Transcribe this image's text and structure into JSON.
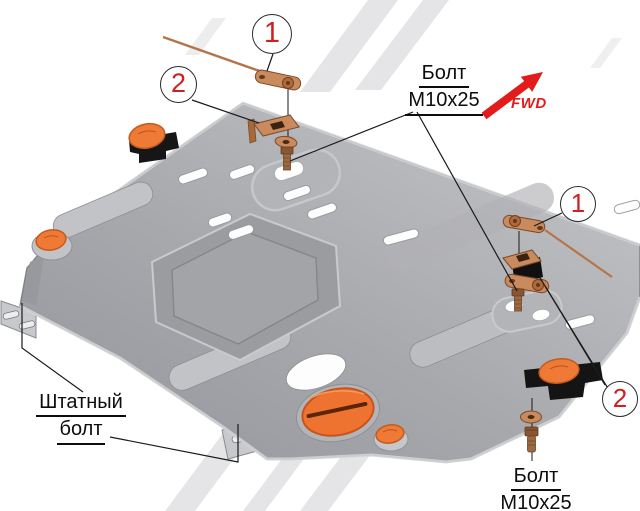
{
  "diagram": {
    "kind": "exploded installation diagram",
    "subject": "engine skid plate with mounting hardware"
  },
  "labels": {
    "bolt_top": {
      "line1": "Болт",
      "line2": "М10х25"
    },
    "bolt_bottom": {
      "line1": "Болт",
      "line2": "М10х25"
    },
    "stock_bolt": {
      "line1": "Штатный",
      "line2": "болт"
    },
    "fwd": "FWD"
  },
  "callouts": [
    {
      "number": "1",
      "position": "top"
    },
    {
      "number": "2",
      "position": "upper-left"
    },
    {
      "number": "1",
      "position": "right"
    },
    {
      "number": "2",
      "position": "lower-right"
    }
  ],
  "colors": {
    "callout_red": "#cf2020",
    "arrow_red": "#e21b1b",
    "plate_gray": "#a6a7ab",
    "copper_hardware": "#c98a5e",
    "plug_orange": "#ee7331",
    "bracket_black": "#141414"
  }
}
